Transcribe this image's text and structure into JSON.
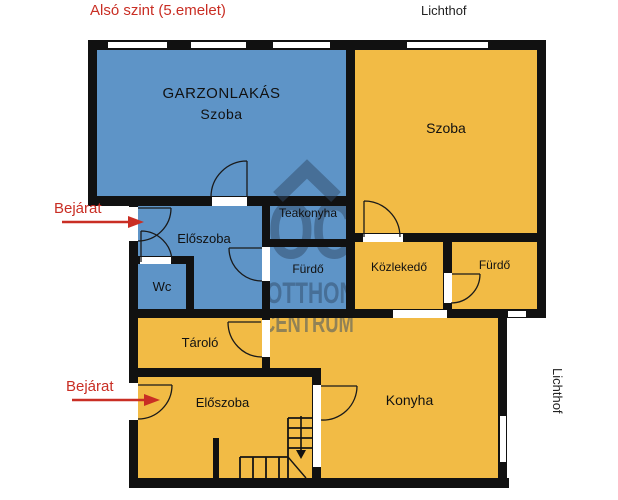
{
  "header": {
    "title": "Alsó szint (5.emelet)"
  },
  "labels": {
    "lichthof_top": "Lichthof",
    "lichthof_right": "Lichthof",
    "bejarat_top": "Bejárat",
    "bejarat_bottom": "Bejárat"
  },
  "rooms": {
    "garzonlakas": {
      "title": "GARZONLAKÁS",
      "subtitle": "Szoba"
    },
    "szoba": "Szoba",
    "teakonyha": "Teakonyha",
    "eloszoba_felso": "Előszoba",
    "wc": "Wc",
    "furdo_bal": "Fürdő",
    "kozlekedo": "Közlekedő",
    "furdo_jobb": "Fürdő",
    "tarolo": "Tároló",
    "eloszoba_also": "Előszoba",
    "konyha": "Konyha"
  },
  "watermark": {
    "line1": "OC",
    "line2": "OTTHON",
    "line3": "CENTRUM"
  },
  "colors": {
    "apartment_blue": "#5E94C7",
    "apartment_yellow": "#F2BB45",
    "wall": "#111111",
    "accent_red": "#C92E24",
    "watermark": "rgba(47,74,104,0.5)"
  }
}
